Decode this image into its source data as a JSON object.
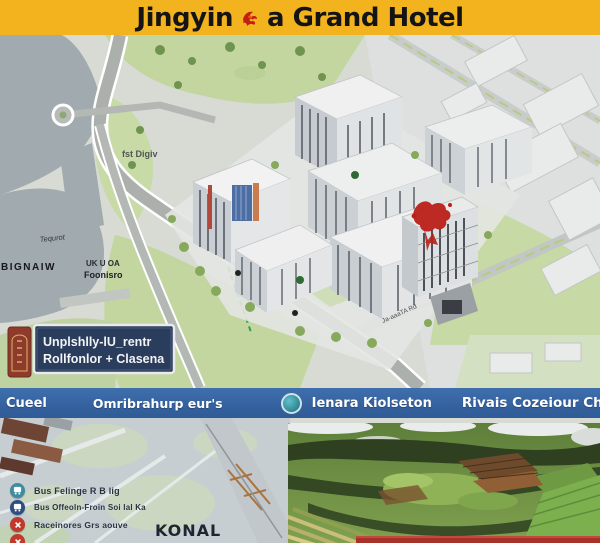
{
  "header": {
    "brand_left": "Jingyin",
    "brand_right": "a Grand Hotel"
  },
  "map": {
    "label_district": "fst Digiv",
    "label_script": "Tequrot",
    "label_left_bold": "BIGNAIW",
    "label_area_line1": "UK U OA",
    "label_area_line2": "Foonisro",
    "label_road": "Ja-aaaTA Rd",
    "sign": {
      "line1": "Unplshlly-lU_rentr",
      "line2": "Rollfonlor + Clasena"
    }
  },
  "legend_bar": {
    "item1": "Cueel",
    "item2": "Omribrahurp eur's",
    "item3": "Ienara Kiolseton",
    "item4": "Rivais Cozeiour Chupeunoreon",
    "note1": "Amarore",
    "note2": "2 ≈"
  },
  "bottom": {
    "legend": [
      {
        "icon": "bus-teal-icon",
        "label": "Bus Felinge R B lig"
      },
      {
        "icon": "bus-navy-icon",
        "label": "Bus Offeoln-Froin Soi lal Ka"
      },
      {
        "icon": "x-red-icon",
        "label": "Raceinores Grs aouve"
      },
      {
        "icon": "x-red-icon",
        "label": ""
      }
    ],
    "caption": "KONAL"
  },
  "colors": {
    "banner_yellow": "#F2B31E",
    "bar_blue": "#35629F",
    "sign_navy": "#2B3D5C",
    "legend_red": "#C0392B",
    "legend_teal": "#3E8CA0",
    "graffiti_red": "#BB1F18",
    "map_green": "#C3D6A0",
    "water_gray": "#A1AAAE",
    "tower_blue": "#4C6EA2"
  }
}
